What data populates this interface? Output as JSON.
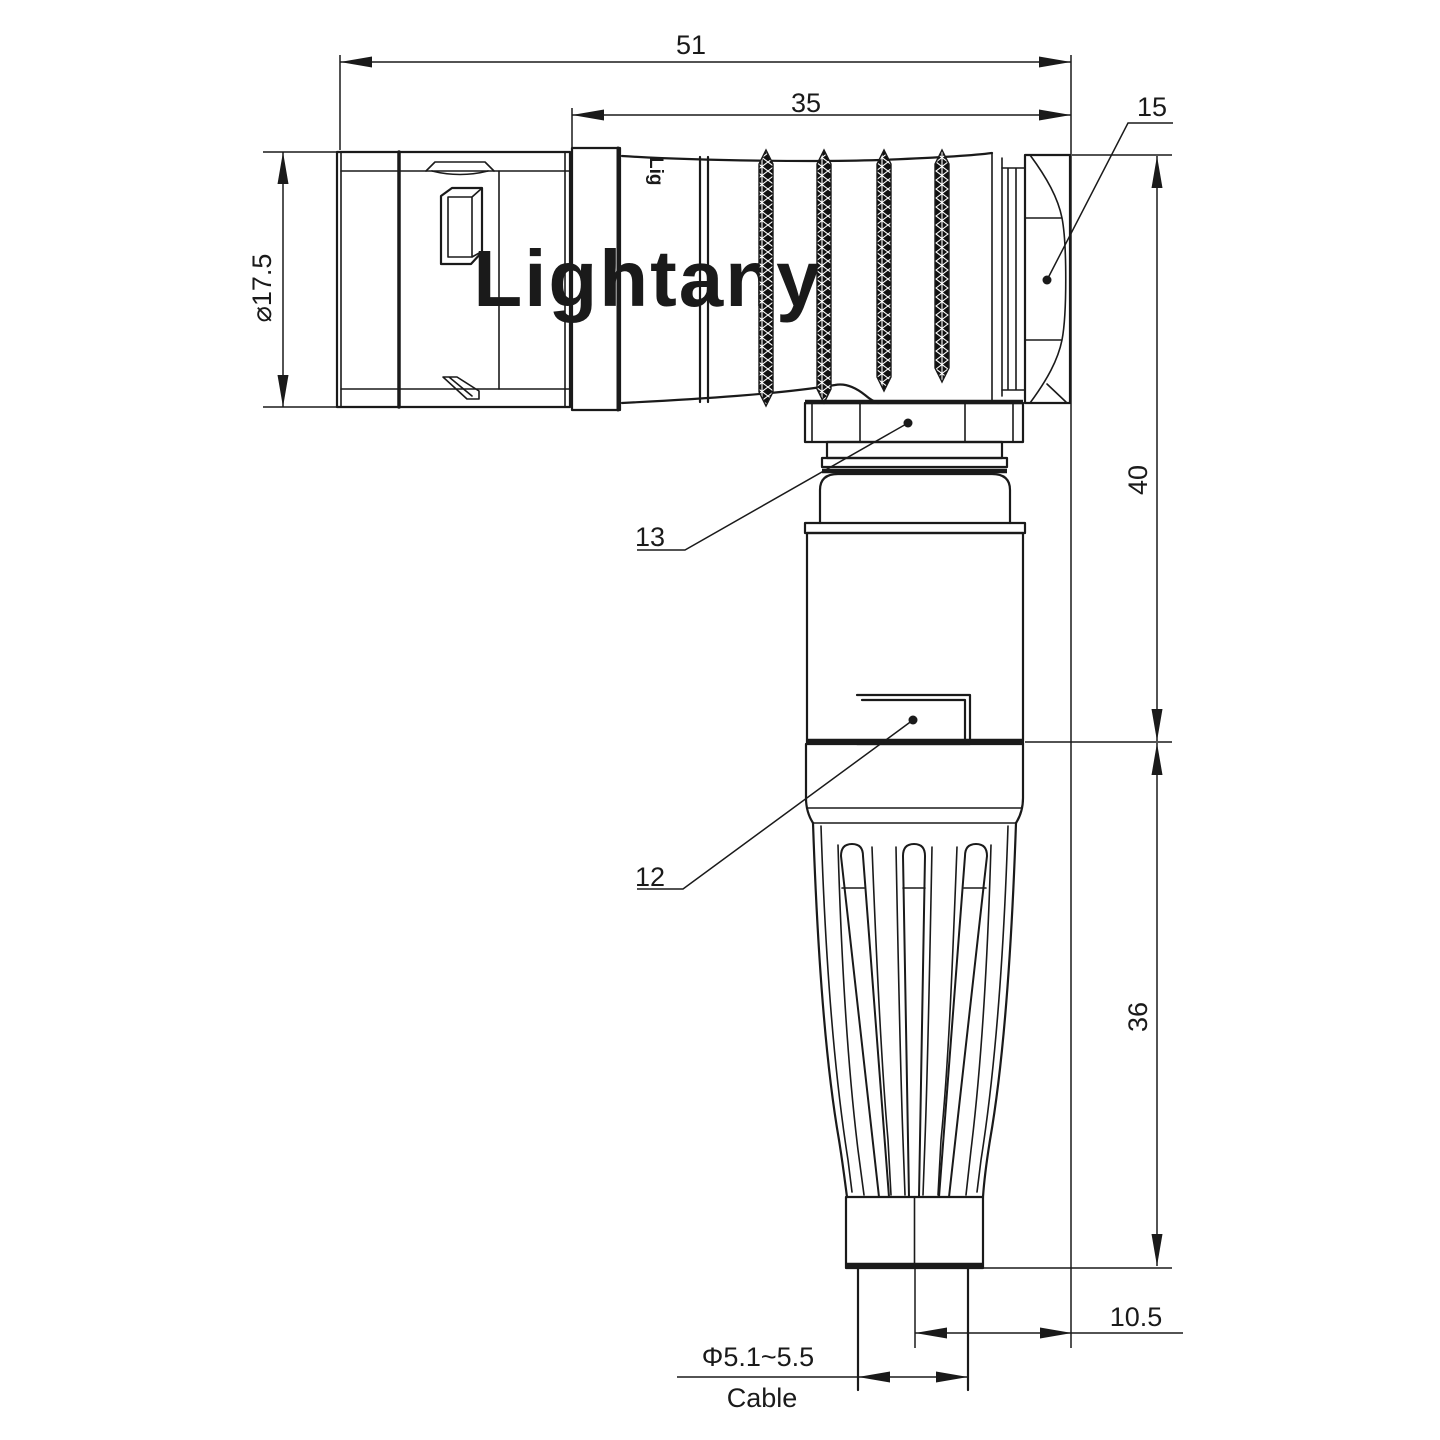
{
  "page": {
    "background": "#ffffff"
  },
  "drawing": {
    "title_watermark": "Lightany",
    "body_marking": "Lig",
    "colors": {
      "line": "#1a1a1a",
      "watermark": "#f2d7d7"
    },
    "dimensions": {
      "overall_length": "51",
      "rear_length": "35",
      "backnut_ref": "15",
      "front_diameter": "⌀17.5",
      "elbow_height": "40",
      "boot_length": "36",
      "cable_offset": "10.5",
      "nut_ref": "13",
      "housing_ref": "12",
      "cable_diameter": "Φ5.1~5.5",
      "cable_label": "Cable"
    }
  }
}
